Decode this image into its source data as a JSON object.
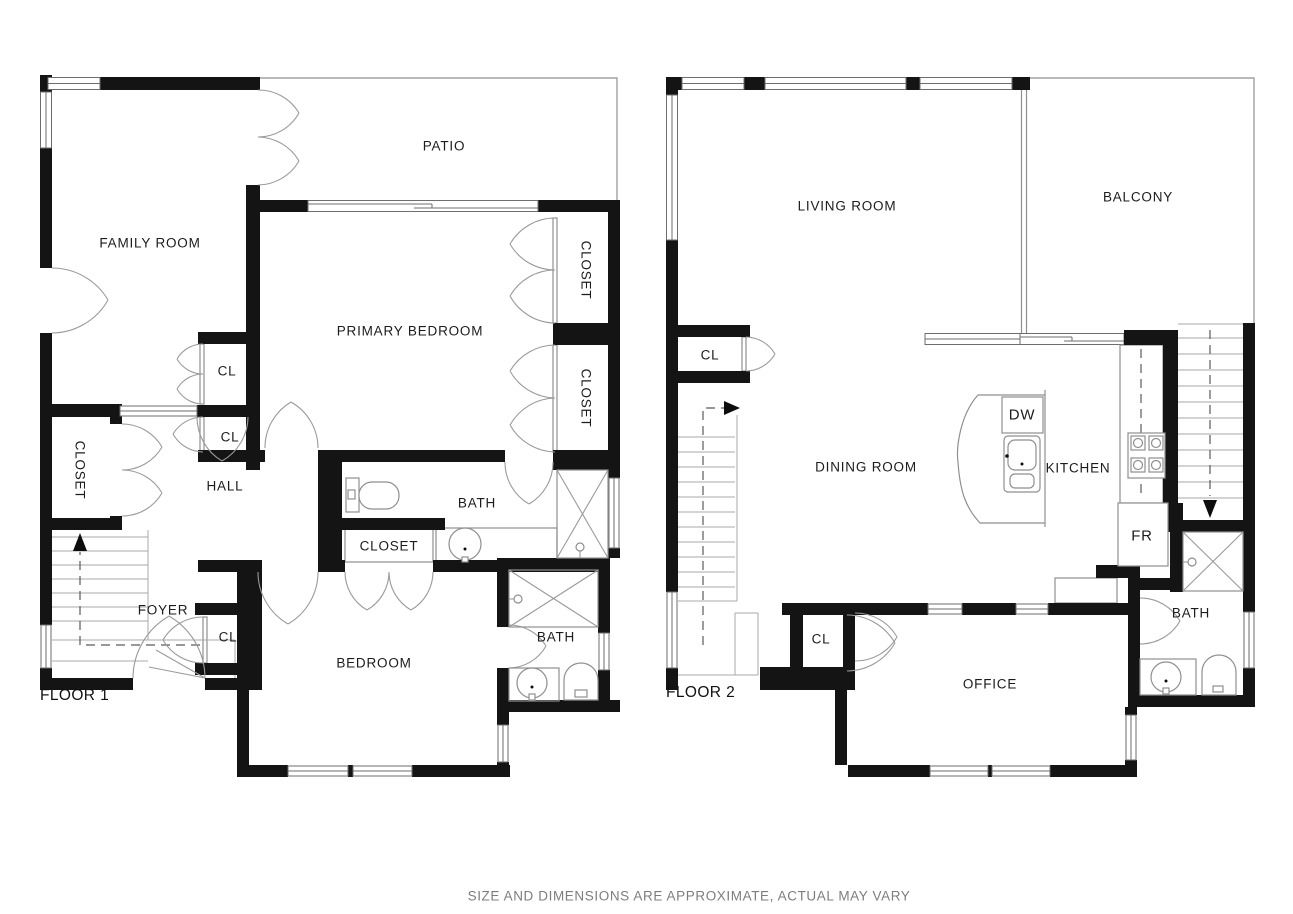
{
  "floor1": {
    "label": "FLOOR 1",
    "rooms": {
      "family_room": "FAMILY ROOM",
      "patio": "PATIO",
      "primary_bedroom": "PRIMARY BEDROOM",
      "closet_right_upper": "CLOSET",
      "closet_right_lower": "CLOSET",
      "cl_family": "CL",
      "cl_hall": "CL",
      "hall": "HALL",
      "closet_left": "CLOSET",
      "bath": "BATH",
      "closet_bath": "CLOSET",
      "foyer": "FOYER",
      "cl_foyer": "CL",
      "bedroom": "BEDROOM",
      "bath_2": "BATH"
    }
  },
  "floor2": {
    "label": "FLOOR 2",
    "rooms": {
      "living_room": "LIVING ROOM",
      "balcony": "BALCONY",
      "cl_upper": "CL",
      "dining_room": "DINING ROOM",
      "dishwasher": "DW",
      "kitchen": "KITCHEN",
      "fridge": "FR",
      "bath": "BATH",
      "cl_lower": "CL",
      "office": "OFFICE"
    }
  },
  "footer": {
    "disclaimer": "SIZE AND DIMENSIONS ARE APPROXIMATE, ACTUAL MAY VARY"
  },
  "colors": {
    "wall": "#141414",
    "thin_line": "#8f8f8f",
    "disclaimer_text": "#7d7d7d"
  }
}
